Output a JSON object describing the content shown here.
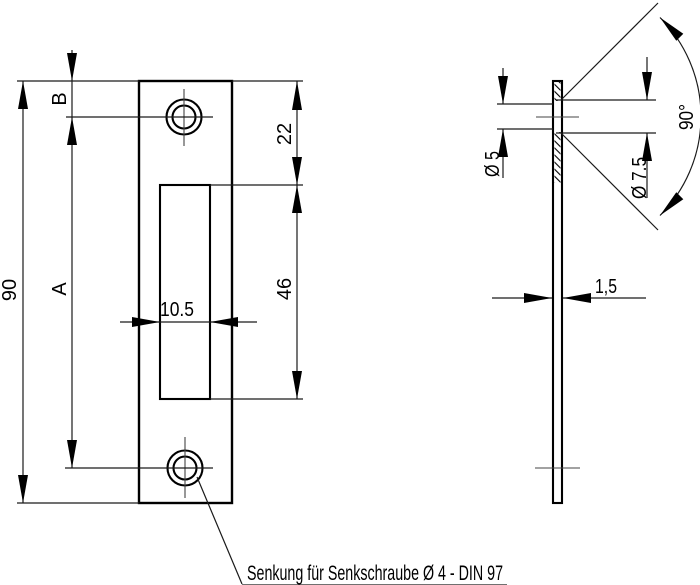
{
  "drawing_type": "technical drawing of a strike plate (front view and side section view)",
  "front_view": {
    "dim_overall_height": "90",
    "dim_hole_center_distance": "A",
    "dim_top_edge_to_hole_center": "B",
    "dim_top_edge_to_slot": "22",
    "dim_slot_height": "46",
    "dim_slot_width": "10.5"
  },
  "side_view": {
    "dim_hole_diameter": "Ø 5",
    "dim_countersink_diameter": "Ø 7.5",
    "dim_countersink_angle": "90°",
    "dim_thickness": "1,5"
  },
  "callout": {
    "text": "Senkung für Senkschraube Ø 4 - DIN 97"
  },
  "colors": {
    "line": "#000000",
    "centerline": "#444444",
    "background": "#ffffff"
  }
}
